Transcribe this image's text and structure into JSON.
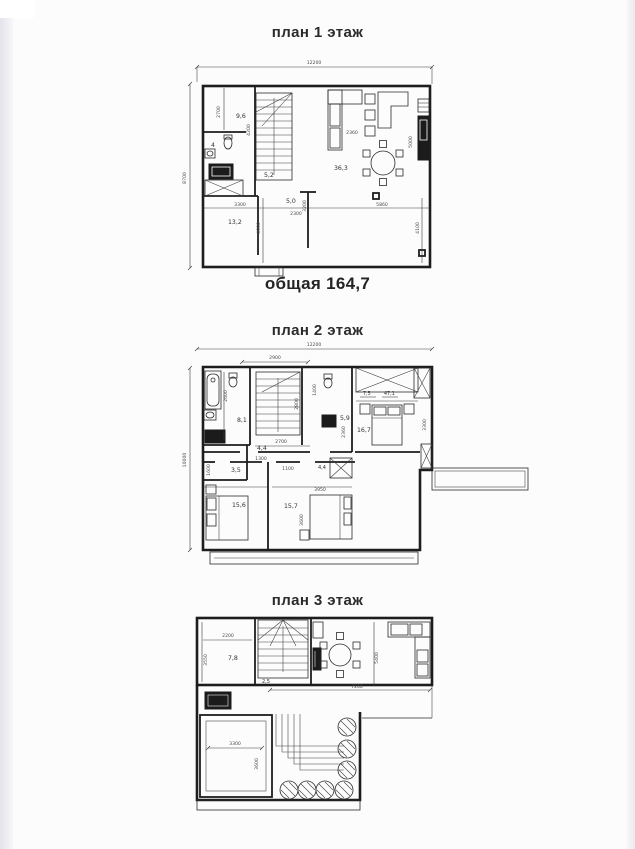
{
  "floor1": {
    "title": "план 1 этаж",
    "caption": "общая 164,7",
    "rooms": {
      "hall_top": "9,6",
      "wc": "4",
      "room_bottom": "13,2",
      "stair_hall": "5,2",
      "entry": "5,0",
      "living": "36,3"
    },
    "dims": {
      "width_total": "12200",
      "height_total": "8700",
      "d2700": "2700",
      "d4200": "4200",
      "d3300": "3300",
      "d4000": "4000",
      "d2300": "2300",
      "d3200": "3200",
      "d5860": "5860",
      "d4100": "4100",
      "d2360": "2360",
      "d5000": "5000"
    }
  },
  "floor2": {
    "title": "план 2 этаж",
    "rooms": {
      "bath": "8,1",
      "wc": "5,9",
      "hall": "4,4",
      "wardrobe": "7,5",
      "wardrobe2": "47,1",
      "bedroom_right": "16,7",
      "storage": "3,5",
      "bedroom_left": "15,6",
      "bedroom_mid": "15,7",
      "closet": "4,4"
    },
    "dims": {
      "width_total": "12200",
      "height_total": "10000",
      "d2900": "2900",
      "d2600": "2600",
      "d1400": "1400",
      "d2800": "2800",
      "d2700": "2700",
      "d2360": "2360",
      "d3300": "3300",
      "d1600": "1600",
      "d1300": "1300",
      "d1100": "1100",
      "d3950": "3950",
      "d3600": "3600"
    }
  },
  "floor3": {
    "title": "план 3 этаж",
    "rooms": {
      "room": "7,8",
      "landing": "2,5"
    },
    "dims": {
      "d2200": "2200",
      "d3550": "3550",
      "d7200": "7200",
      "d5400": "5400",
      "d3300": "3300",
      "d3600": "3600"
    }
  }
}
